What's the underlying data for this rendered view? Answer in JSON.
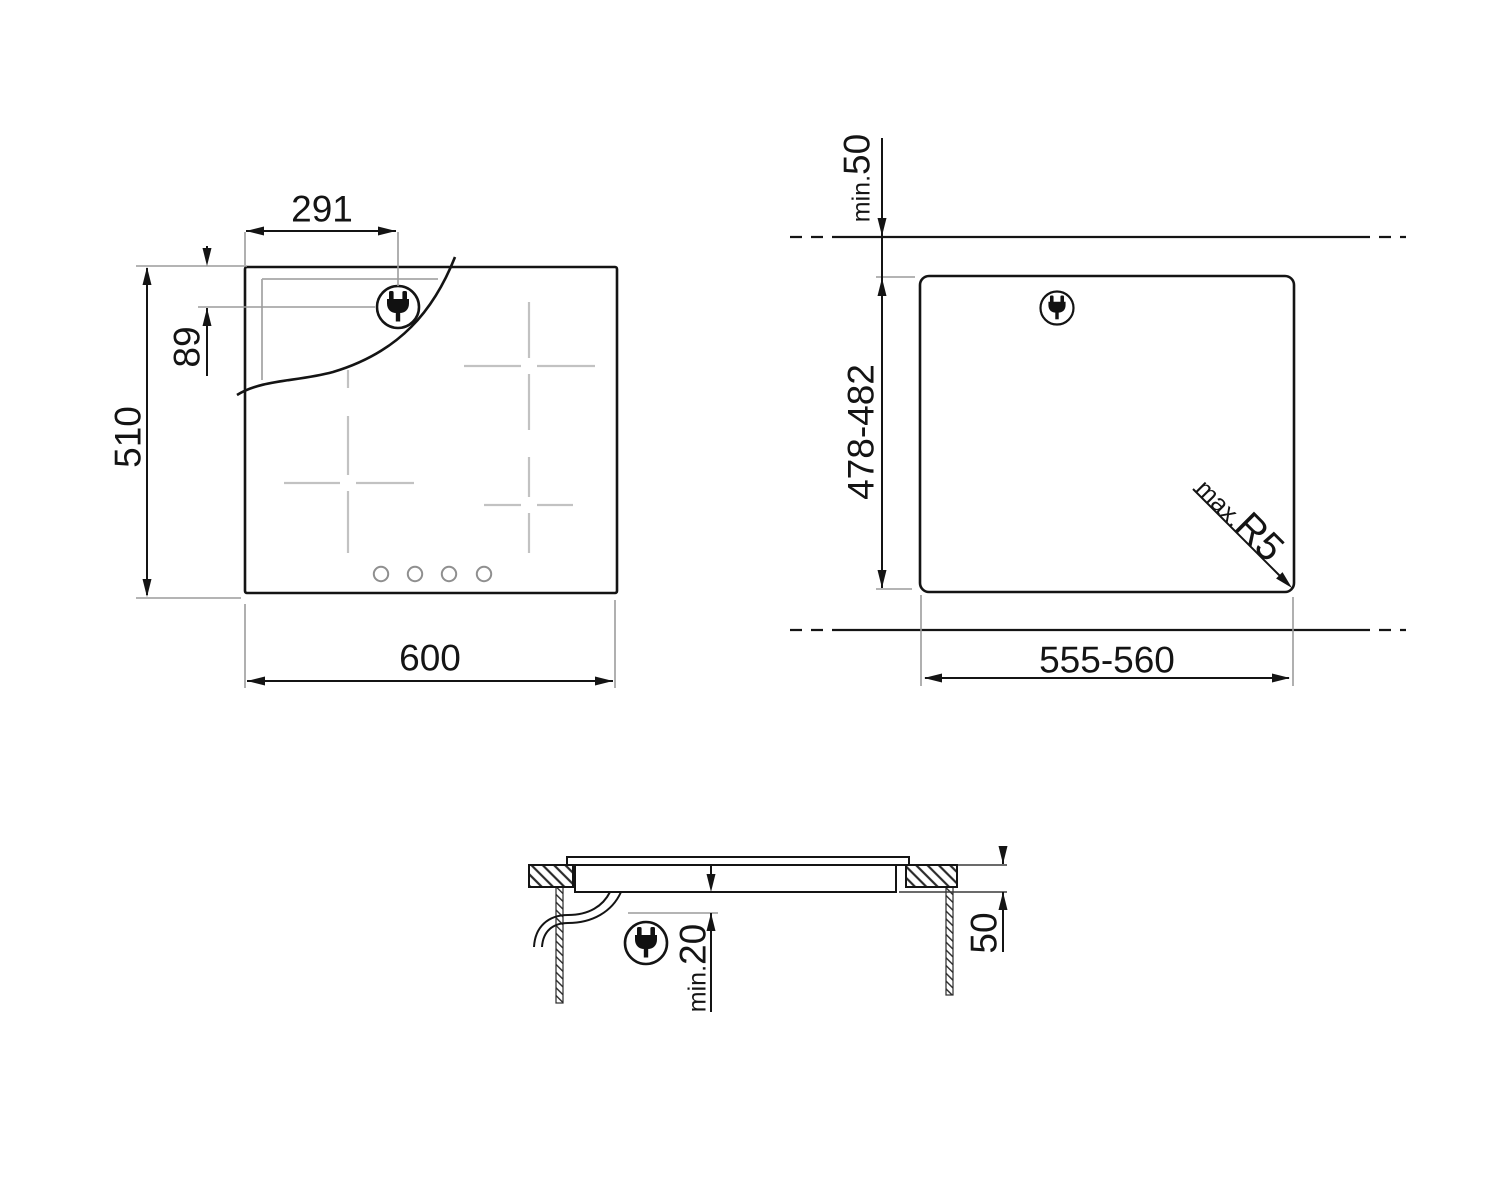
{
  "colors": {
    "line": "#141414",
    "reference": "#9c9c9c",
    "zone_marks": "#c2c2c2",
    "background": "#ffffff"
  },
  "top_view": {
    "dim_plug_x": "291",
    "dim_plug_y": "89",
    "dim_height": "510",
    "dim_width": "600"
  },
  "cutout_view": {
    "clearance_prefix": "min.",
    "clearance_value": "50",
    "depth_range": "478-482",
    "radius_prefix": "max.",
    "radius_value": "R5",
    "width_range": "555-560"
  },
  "section_view": {
    "clearance_prefix": "min.",
    "clearance_value": "20",
    "thickness": "50"
  },
  "icons": {
    "plug": "power-plug-icon"
  }
}
